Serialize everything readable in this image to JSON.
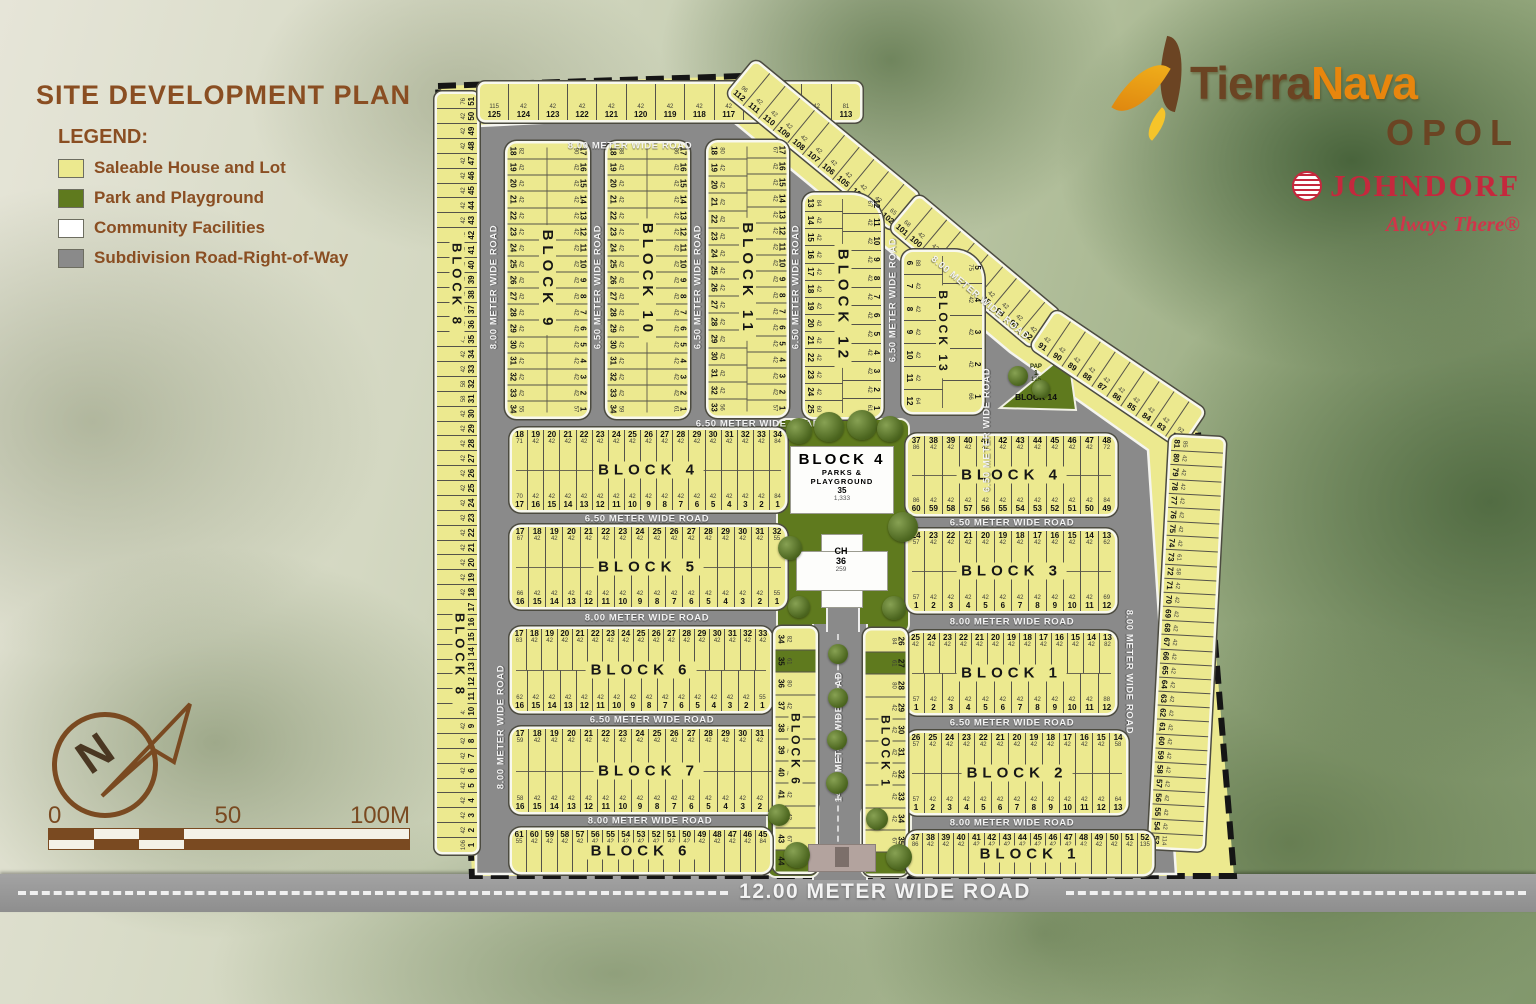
{
  "title": "SITE DEVELOPMENT PLAN",
  "legend": {
    "heading": "LEGEND:",
    "items": [
      {
        "label": "Saleable House and Lot",
        "color": "#ece98f"
      },
      {
        "label": "Park and Playground",
        "color": "#5f7a1e"
      },
      {
        "label": "Community Facilities",
        "color": "#ffffff"
      },
      {
        "label": "Subdivision Road-Right-of-Way",
        "color": "#8a8a8a"
      }
    ]
  },
  "branding": {
    "brand_tierra": "Tierra",
    "brand_nava": "Nava",
    "location": "OPOL",
    "developer": "JOHNDORF",
    "tagline": "Always There®"
  },
  "compass_label": "N",
  "scale": {
    "t0": "0",
    "t50": "50",
    "t100": "100M"
  },
  "block8_label": "BLOCK 8",
  "lot_area_default": "42",
  "roads": {
    "labels": {
      "top8": "8.00 METER WIDE ROAD",
      "left8_upper": "8.00 METER WIDE ROAD",
      "left8_lower": "8.00 METER WIDE ROAD",
      "v650_910": "6.50 METER WIDE ROAD",
      "v650_1011": "6.50 METER WIDE ROAD",
      "v650_1112": "6.50 METER WIDE ROAD",
      "v650_1213": "6.50 METER WIDE ROAD",
      "v650_13": "6.50 METER WIDE ROAD",
      "h650_top": "6.50 METER WIDE ROAD",
      "h650_b4l": "6.50 METER WIDE ROAD",
      "h650_b4r": "6.50 METER WIDE ROAD",
      "h800_b5": "8.00 METER WIDE ROAD",
      "h800_b3": "8.00 METER WIDE ROAD",
      "h650_b6": "6.50 METER WIDE ROAD",
      "h650_b1": "6.50 METER WIDE ROAD",
      "h800_b7": "8.00 METER WIDE ROAD",
      "h800_b2": "8.00 METER WIDE ROAD",
      "diag8": "8.00 METER WIDE ROAD",
      "right8": "8.00 METER WIDE ROAD",
      "v14": "14.00 METER WIDE ROAD",
      "main12": "12.00 METER WIDE ROAD"
    }
  },
  "park": {
    "line1": "BLOCK 4",
    "line2": "PARKS & PLAYGROUND",
    "lot": "35",
    "area": "1,333"
  },
  "ch": {
    "name": "CH",
    "lot": "36",
    "area": "259"
  },
  "block14": {
    "tag": "PAP",
    "lot": "1",
    "area": "125",
    "label": "BLOCK 14"
  },
  "strips": {
    "p_left": {
      "rows": [
        {
          "from": 1,
          "to": 51,
          "side": "bottom",
          "areas": {
            "1": "106",
            "11": "58",
            "12": "58",
            "31": "58",
            "32": "58",
            "51": "76"
          }
        }
      ]
    },
    "p_top": {
      "rows": [
        {
          "from": 125,
          "to": 113,
          "side": "bottom",
          "areas": {
            "125": "115",
            "113": "81"
          }
        }
      ]
    },
    "p_diag_a": {
      "rows": [
        {
          "from": 112,
          "to": 102,
          "side": "bottom",
          "areas": {
            "112": "96",
            "102": "65"
          }
        }
      ]
    },
    "p_diag_b": {
      "rows": [
        {
          "from": 101,
          "to": 92,
          "side": "bottom",
          "areas": {
            "101": "68"
          }
        }
      ]
    },
    "p_diag_c": {
      "rows": [
        {
          "from": 91,
          "to": 82,
          "side": "bottom",
          "areas": {
            "82": "92"
          }
        }
      ]
    },
    "p_right": {
      "rows": [
        {
          "from": 81,
          "to": 53,
          "side": "bottom",
          "areas": {
            "81": "85",
            "73": "61",
            "72": "58",
            "53": "114"
          }
        }
      ]
    },
    "b9": {
      "label": "BLOCK 9",
      "rows": [
        {
          "from": 17,
          "to": 1,
          "side": "top",
          "areas": {
            "17": "90",
            "1": "57"
          }
        },
        {
          "from": 18,
          "to": 34,
          "side": "bottom",
          "areas": {
            "18": "82",
            "34": "55"
          }
        }
      ]
    },
    "b10": {
      "label": "BLOCK 10",
      "rows": [
        {
          "from": 17,
          "to": 1,
          "side": "top",
          "areas": {
            "17": "86",
            "1": "61"
          }
        },
        {
          "from": 18,
          "to": 34,
          "side": "bottom",
          "areas": {
            "18": "88",
            "34": "59"
          }
        }
      ]
    },
    "b11": {
      "label": "BLOCK 11",
      "rows": [
        {
          "from": 17,
          "to": 1,
          "side": "top",
          "areas": {
            "17": "67",
            "1": "57"
          }
        },
        {
          "from": 18,
          "to": 33,
          "side": "bottom",
          "areas": {
            "18": "80",
            "33": "56"
          }
        }
      ]
    },
    "b12": {
      "label": "BLOCK 12",
      "rows": [
        {
          "from": 12,
          "to": 1,
          "side": "top",
          "areas": {
            "12": "67",
            "1": "61"
          }
        },
        {
          "from": 13,
          "to": 25,
          "side": "bottom",
          "areas": {
            "13": "84",
            "25": "60"
          }
        }
      ]
    },
    "b13": {
      "label": "BLOCK 13",
      "rows": [
        {
          "from": 5,
          "to": 1,
          "side": "top",
          "areas": {
            "5": "75",
            "1": "66"
          }
        },
        {
          "from": 6,
          "to": 12,
          "side": "bottom",
          "areas": {
            "6": "88",
            "12": "64"
          }
        }
      ]
    },
    "b4l": {
      "label": "BLOCK 4",
      "rows": [
        {
          "from": 18,
          "to": 34,
          "side": "top",
          "areas": {
            "18": "71",
            "34": "84"
          }
        },
        {
          "from": 17,
          "to": 1,
          "side": "bottom",
          "areas": {
            "17": "70",
            "1": "84"
          }
        }
      ]
    },
    "b4r": {
      "label": "BLOCK 4",
      "rows": [
        {
          "from": 37,
          "to": 48,
          "side": "top",
          "areas": {
            "37": "86",
            "48": "72"
          }
        },
        {
          "from": 60,
          "to": 49,
          "side": "bottom",
          "areas": {
            "60": "86",
            "49": "84"
          }
        }
      ]
    },
    "b5": {
      "label": "BLOCK 5",
      "rows": [
        {
          "from": 17,
          "to": 32,
          "side": "top",
          "areas": {
            "17": "67",
            "32": "55"
          }
        },
        {
          "from": 16,
          "to": 1,
          "side": "bottom",
          "areas": {
            "16": "66",
            "1": "55"
          }
        }
      ]
    },
    "b3": {
      "label": "BLOCK 3",
      "rows": [
        {
          "from": 24,
          "to": 13,
          "side": "top",
          "areas": {
            "24": "57",
            "13": "62"
          }
        },
        {
          "from": 1,
          "to": 12,
          "side": "bottom",
          "areas": {
            "1": "57",
            "12": "69"
          }
        }
      ]
    },
    "b6mid": {
      "label": "BLOCK 6",
      "rows": [
        {
          "from": 17,
          "to": 33,
          "side": "top",
          "areas": {
            "17": "63"
          }
        },
        {
          "from": 16,
          "to": 1,
          "side": "bottom",
          "areas": {
            "16": "62",
            "1": "55"
          }
        }
      ]
    },
    "b1mid": {
      "label": "BLOCK 1",
      "rows": [
        {
          "from": 25,
          "to": 13,
          "side": "top",
          "areas": {
            "13": "82"
          }
        },
        {
          "from": 1,
          "to": 12,
          "side": "bottom",
          "areas": {
            "1": "57",
            "12": "88"
          }
        }
      ]
    },
    "b7": {
      "label": "BLOCK 7",
      "rows": [
        {
          "from": 17,
          "to": 32,
          "side": "top",
          "areas": {
            "17": "59",
            "32": "55"
          }
        },
        {
          "from": 16,
          "to": 1,
          "side": "bottom",
          "areas": {
            "16": "58",
            "1": "55"
          }
        }
      ]
    },
    "b2": {
      "label": "BLOCK 2",
      "rows": [
        {
          "from": 26,
          "to": 14,
          "side": "top",
          "areas": {
            "26": "57",
            "14": "58"
          }
        },
        {
          "from": 1,
          "to": 13,
          "side": "bottom",
          "areas": {
            "1": "57",
            "13": "64"
          }
        }
      ]
    },
    "b6v": {
      "label": "BLOCK 6",
      "green": [
        35,
        44
      ],
      "rows": [
        {
          "from": 34,
          "to": 44,
          "side": "bottom",
          "areas": {
            "34": "82",
            "35": "61",
            "36": "80",
            "43": "67",
            "44": "109"
          }
        }
      ]
    },
    "b1v": {
      "label": "BLOCK 1",
      "green": [
        27,
        36
      ],
      "rows": [
        {
          "from": 26,
          "to": 36,
          "side": "top",
          "areas": {
            "26": "84",
            "27": "61",
            "28": "80",
            "35": "67",
            "36": "84"
          }
        }
      ]
    },
    "b6bot": {
      "label": "BLOCK 6",
      "rows": [
        {
          "from": 61,
          "to": 45,
          "side": "top",
          "areas": {
            "61": "55",
            "45": "84"
          }
        }
      ]
    },
    "b1bot": {
      "label": "BLOCK 1",
      "rows": [
        {
          "from": 37,
          "to": 52,
          "side": "top",
          "areas": {
            "37": "86",
            "52": "135"
          }
        }
      ]
    }
  }
}
